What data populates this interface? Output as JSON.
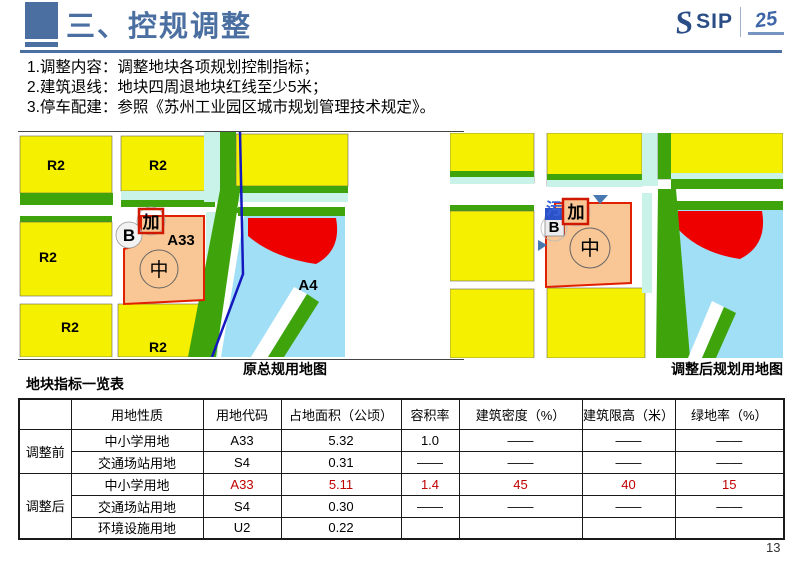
{
  "header": {
    "title": "三、控规调整",
    "logo": {
      "name": "SIP",
      "mark": "25"
    }
  },
  "notes": [
    "1.调整内容：调整地块各项规划控制指标；",
    "2.建筑退线：地块四周退地块红线至少5米；",
    "3.停车配建：参照《苏州工业园区城市规划管理技术规定》。"
  ],
  "maps": {
    "left": {
      "caption": "原总规用地图",
      "labels": {
        "r2_top_left": "R2",
        "r2_top_mid": "R2",
        "r2_mid_left": "R2",
        "r2_bottom_left": "R2",
        "r2_bottom_mid": "R2",
        "parcel_code": "A33",
        "lake_code": "A4",
        "b_mark": "B",
        "jia_mark": "加",
        "zhong_mark": "中"
      }
    },
    "right": {
      "caption": "调整后规划用地图",
      "labels": {
        "b_mark": "B",
        "jia_mark": "加",
        "wu_mark": "污",
        "zhong_mark": "中"
      }
    }
  },
  "table": {
    "title": "地块指标一览表",
    "headers": [
      "",
      "用地性质",
      "用地代码",
      "占地面积（公顷）",
      "容积率",
      "建筑密度（%）",
      "建筑限高（米）",
      "绿地率（%）"
    ],
    "groups": [
      {
        "label": "调整前",
        "rows": [
          {
            "cells": [
              "中小学用地",
              "A33",
              "5.32",
              "1.0",
              "——",
              "——",
              "——"
            ]
          },
          {
            "cells": [
              "交通场站用地",
              "S4",
              "0.31",
              "——",
              "——",
              "——",
              "——"
            ]
          }
        ]
      },
      {
        "label": "调整后",
        "rows": [
          {
            "cells": [
              "中小学用地",
              "A33",
              "5.11",
              "1.4",
              "45",
              "40",
              "15"
            ]
          },
          {
            "cells": [
              "交通场站用地",
              "S4",
              "0.30",
              "——",
              "——",
              "——",
              "——"
            ]
          },
          {
            "cells": [
              "环境设施用地",
              "U2",
              "0.22",
              "",
              "",
              "",
              ""
            ]
          }
        ]
      }
    ]
  },
  "page_number": "13",
  "colors": {
    "accent_blue": "#4A6FA0",
    "logo_blue": "#2B4D86",
    "highlight_red": "#C00000",
    "map_yellow": "#F5EF00",
    "map_green": "#3FA30B",
    "map_cyan": "#C9F2E8",
    "map_salmon": "#F9C795",
    "map_red": "#EE0000",
    "map_lake": "#A0DFF5",
    "map_line_blue": "#1518BE"
  }
}
